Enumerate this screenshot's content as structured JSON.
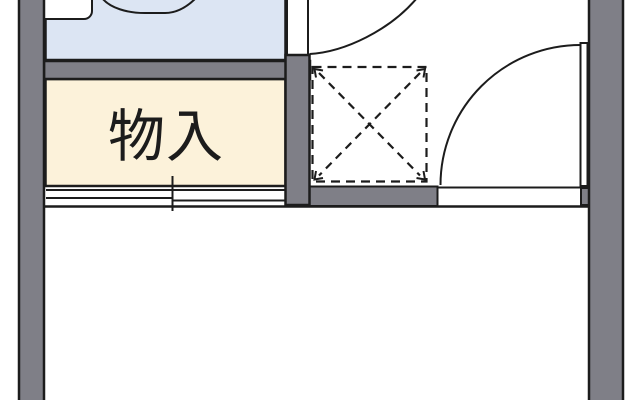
{
  "plan": {
    "colors": {
      "wall": "#7f7f87",
      "outline": "#1c1c1c",
      "bathroom": "#dce5f3",
      "storage": "#fcf2da",
      "floor": "#ffffff"
    },
    "rooms": {
      "storage": {
        "label": "物入"
      }
    },
    "symbols": {
      "washer_space": "dashed-square-with-cross-arrows",
      "door_top": "quarter-arc-swing",
      "door_right": "quarter-arc-swing-with-leaf",
      "sliding_door": "offset-double-line",
      "bathtub": "rounded-rect-partial"
    }
  }
}
